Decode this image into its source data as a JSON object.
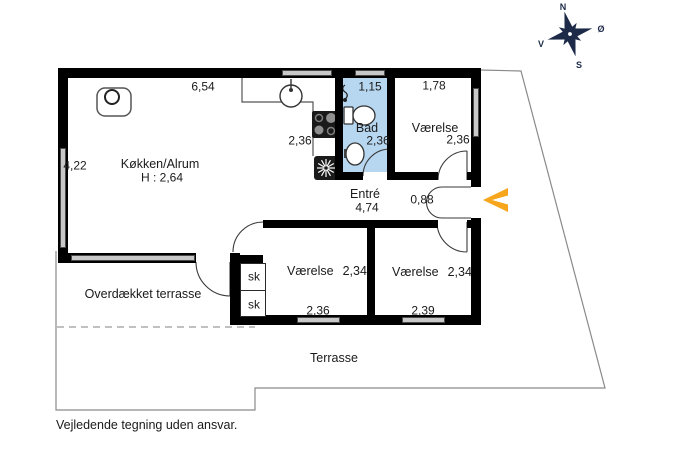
{
  "floorplan": {
    "kitchen": {
      "name": "Køkken/Alrum",
      "ceiling_height": "H : 2,64",
      "dim_top": "6,54",
      "dim_left": "4,22",
      "dim_right": "2,36"
    },
    "bath": {
      "name": "Bad",
      "dim_top": "1,15",
      "dim": "2,36"
    },
    "bedroom_top_right": {
      "name": "Værelse",
      "dim_top": "1,78",
      "dim": "2,36"
    },
    "hall": {
      "name": "Entré",
      "dim_length": "4,74",
      "dim_width": "0,88"
    },
    "bedroom_bottom_left": {
      "name": "Værelse",
      "dim": "2,34",
      "dim_bottom": "2,36"
    },
    "bedroom_bottom_right": {
      "name": "Værelse",
      "dim": "2,34",
      "dim_bottom": "2,39"
    },
    "closet_upper": {
      "label": "sk"
    },
    "closet_lower": {
      "label": "sk"
    },
    "covered_terrace": {
      "name": "Overdækket terrasse"
    },
    "terrace": {
      "name": "Terrasse"
    }
  },
  "compass": {
    "north": "N",
    "east": "Ø",
    "west": "V",
    "south": "S"
  },
  "footer": {
    "disclaimer": "Vejledende tegning uden ansvar."
  },
  "colors": {
    "bath_fill": "#b7d6ef",
    "arrow": "#f7a61b",
    "compass": "#1d2b49",
    "wall": "#000000",
    "window_fill": "#c8c8c8"
  }
}
